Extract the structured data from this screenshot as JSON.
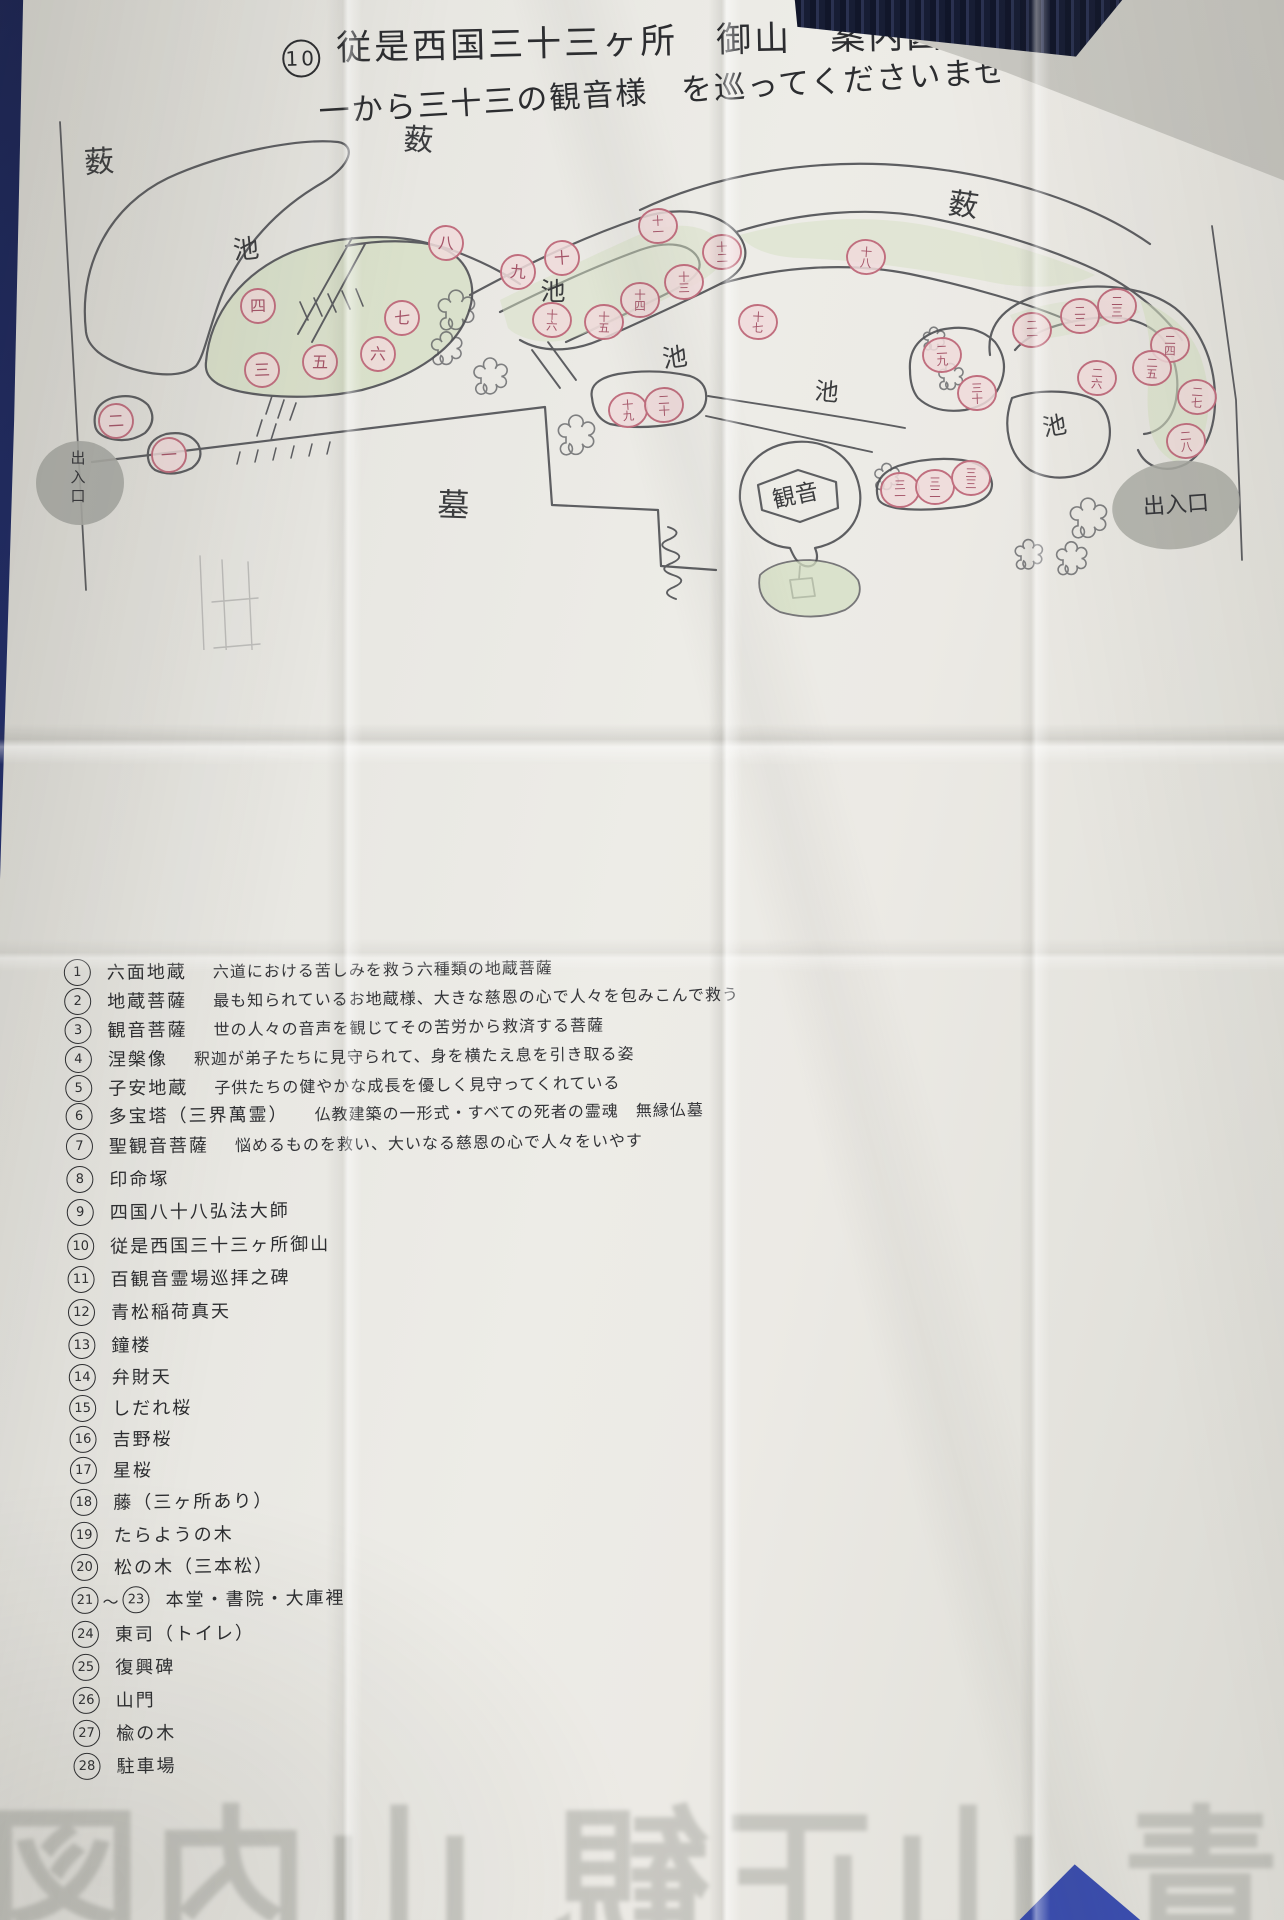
{
  "title": {
    "prefix_num": "10",
    "line1": "従是西国三十三ヶ所　御山　案内図",
    "line2": "一から三十三の観音様　を巡ってくださいませ"
  },
  "map": {
    "ink_color": "#505155",
    "island_color": "#d5dfc3",
    "circle_fill": "#f0dada",
    "circle_stroke": "#c06e7e",
    "circle_text_color": "#a55468",
    "label_color": "#3b3c3e",
    "blob_color": "#aaaba5",
    "area_labels": [
      {
        "text": "薮",
        "x": 100,
        "y": 172,
        "size": 30,
        "rot": -4
      },
      {
        "text": "薮",
        "x": 418,
        "y": 150,
        "size": 30,
        "rot": 3
      },
      {
        "text": "薮",
        "x": 962,
        "y": 215,
        "size": 30,
        "rot": 8
      },
      {
        "text": "池",
        "x": 247,
        "y": 258,
        "size": 26,
        "rot": -6
      },
      {
        "text": "池",
        "x": 553,
        "y": 300,
        "size": 25,
        "rot": 0
      },
      {
        "text": "池",
        "x": 676,
        "y": 366,
        "size": 25,
        "rot": -8
      },
      {
        "text": "池",
        "x": 826,
        "y": 400,
        "size": 24,
        "rot": 5
      },
      {
        "text": "池",
        "x": 1056,
        "y": 434,
        "size": 24,
        "rot": -10
      },
      {
        "text": "墓",
        "x": 453,
        "y": 516,
        "size": 32,
        "rot": 2
      },
      {
        "text": "観音",
        "x": 797,
        "y": 503,
        "size": 23,
        "rot": -12
      }
    ],
    "entrances": [
      {
        "text": "出入口",
        "x": 80,
        "y": 483,
        "vertical": true
      },
      {
        "text": "出入口",
        "x": 1176,
        "y": 505,
        "vertical": false
      }
    ],
    "stations": [
      {
        "n": "一",
        "x": 169,
        "y": 455
      },
      {
        "n": "二",
        "x": 116,
        "y": 421
      },
      {
        "n": "三",
        "x": 262,
        "y": 370
      },
      {
        "n": "四",
        "x": 258,
        "y": 306
      },
      {
        "n": "五",
        "x": 320,
        "y": 362
      },
      {
        "n": "六",
        "x": 378,
        "y": 354
      },
      {
        "n": "七",
        "x": 402,
        "y": 318
      },
      {
        "n": "八",
        "x": 446,
        "y": 243
      },
      {
        "n": "九",
        "x": 518,
        "y": 272
      },
      {
        "n": "十",
        "x": 562,
        "y": 258
      },
      {
        "n": "十一",
        "x": 658,
        "y": 226
      },
      {
        "n": "十二",
        "x": 722,
        "y": 252
      },
      {
        "n": "十三",
        "x": 684,
        "y": 282
      },
      {
        "n": "十四",
        "x": 640,
        "y": 300
      },
      {
        "n": "十五",
        "x": 604,
        "y": 322
      },
      {
        "n": "十六",
        "x": 552,
        "y": 320
      },
      {
        "n": "十七",
        "x": 758,
        "y": 322
      },
      {
        "n": "十八",
        "x": 866,
        "y": 257
      },
      {
        "n": "十九",
        "x": 628,
        "y": 410
      },
      {
        "n": "二十",
        "x": 664,
        "y": 405
      },
      {
        "n": "二一",
        "x": 1032,
        "y": 330
      },
      {
        "n": "二二",
        "x": 1080,
        "y": 316
      },
      {
        "n": "二三",
        "x": 1117,
        "y": 306
      },
      {
        "n": "二四",
        "x": 1170,
        "y": 345
      },
      {
        "n": "二五",
        "x": 1152,
        "y": 368
      },
      {
        "n": "二六",
        "x": 1097,
        "y": 378
      },
      {
        "n": "二七",
        "x": 1197,
        "y": 397
      },
      {
        "n": "二八",
        "x": 1186,
        "y": 441
      },
      {
        "n": "二九",
        "x": 942,
        "y": 355
      },
      {
        "n": "三十",
        "x": 977,
        "y": 393
      },
      {
        "n": "三一",
        "x": 900,
        "y": 490
      },
      {
        "n": "三二",
        "x": 935,
        "y": 487
      },
      {
        "n": "三三",
        "x": 971,
        "y": 478
      }
    ]
  },
  "legend": {
    "items": [
      {
        "num": "1",
        "name": "六面地蔵",
        "desc": "六道における苦しみを救う六種類の地蔵菩薩",
        "y": 952
      },
      {
        "num": "2",
        "name": "地蔵菩薩",
        "desc": "最も知られているお地蔵様、大きな慈恩の心で人々を包みこんで救う",
        "y": 981
      },
      {
        "num": "3",
        "name": "観音菩薩",
        "desc": "世の人々の音声を観じてその苦労から救済する菩薩",
        "y": 1010
      },
      {
        "num": "4",
        "name": "涅槃像",
        "desc": "釈迦が弟子たちに見守られて、身を横たえ息を引き取る姿",
        "y": 1039
      },
      {
        "num": "5",
        "name": "子安地蔵",
        "desc": "子供たちの健やかな成長を優しく見守ってくれている",
        "y": 1068
      },
      {
        "num": "6",
        "name": "多宝塔（三界萬霊）",
        "desc": "仏教建築の一形式・すべての死者の霊魂　無縁仏墓",
        "y": 1096
      },
      {
        "num": "7",
        "name": "聖観音菩薩",
        "desc": "悩めるものを救い、大いなる慈恩の心で人々をいやす",
        "y": 1126
      },
      {
        "num": "8",
        "name": "印命塚",
        "desc": "",
        "y": 1159
      },
      {
        "num": "9",
        "name": "四国八十八弘法大師",
        "desc": "",
        "y": 1192
      },
      {
        "num": "10",
        "name": "従是西国三十三ヶ所御山",
        "desc": "",
        "y": 1226
      },
      {
        "num": "11",
        "name": "百観音霊場巡拝之碑",
        "desc": "",
        "y": 1259
      },
      {
        "num": "12",
        "name": "青松稲荷真天",
        "desc": "",
        "y": 1292
      },
      {
        "num": "13",
        "name": "鐘楼",
        "desc": "",
        "y": 1325
      },
      {
        "num": "14",
        "name": "弁財天",
        "desc": "",
        "y": 1357
      },
      {
        "num": "15",
        "name": "しだれ桜",
        "desc": "",
        "y": 1388
      },
      {
        "num": "16",
        "name": "吉野桜",
        "desc": "",
        "y": 1419
      },
      {
        "num": "17",
        "name": "星桜",
        "desc": "",
        "y": 1450
      },
      {
        "num": "18",
        "name": "藤（三ヶ所あり）",
        "desc": "",
        "y": 1482
      },
      {
        "num": "19",
        "name": "たらようの木",
        "desc": "",
        "y": 1515
      },
      {
        "num": "20",
        "name": "松の木（三本松）",
        "desc": "",
        "y": 1547
      },
      {
        "num": "21",
        "num2": "23",
        "join": "〜",
        "name": "本堂・書院・大庫裡",
        "desc": "",
        "y": 1580
      },
      {
        "num": "24",
        "name": "東司（トイレ）",
        "desc": "",
        "y": 1614
      },
      {
        "num": "25",
        "name": "復興碑",
        "desc": "",
        "y": 1647
      },
      {
        "num": "26",
        "name": "山門",
        "desc": "",
        "y": 1680
      },
      {
        "num": "27",
        "name": "楡の木",
        "desc": "",
        "y": 1713
      },
      {
        "num": "28",
        "name": "駐車場",
        "desc": "",
        "y": 1746
      }
    ]
  },
  "bleed_text": "青 山正観 山内図"
}
